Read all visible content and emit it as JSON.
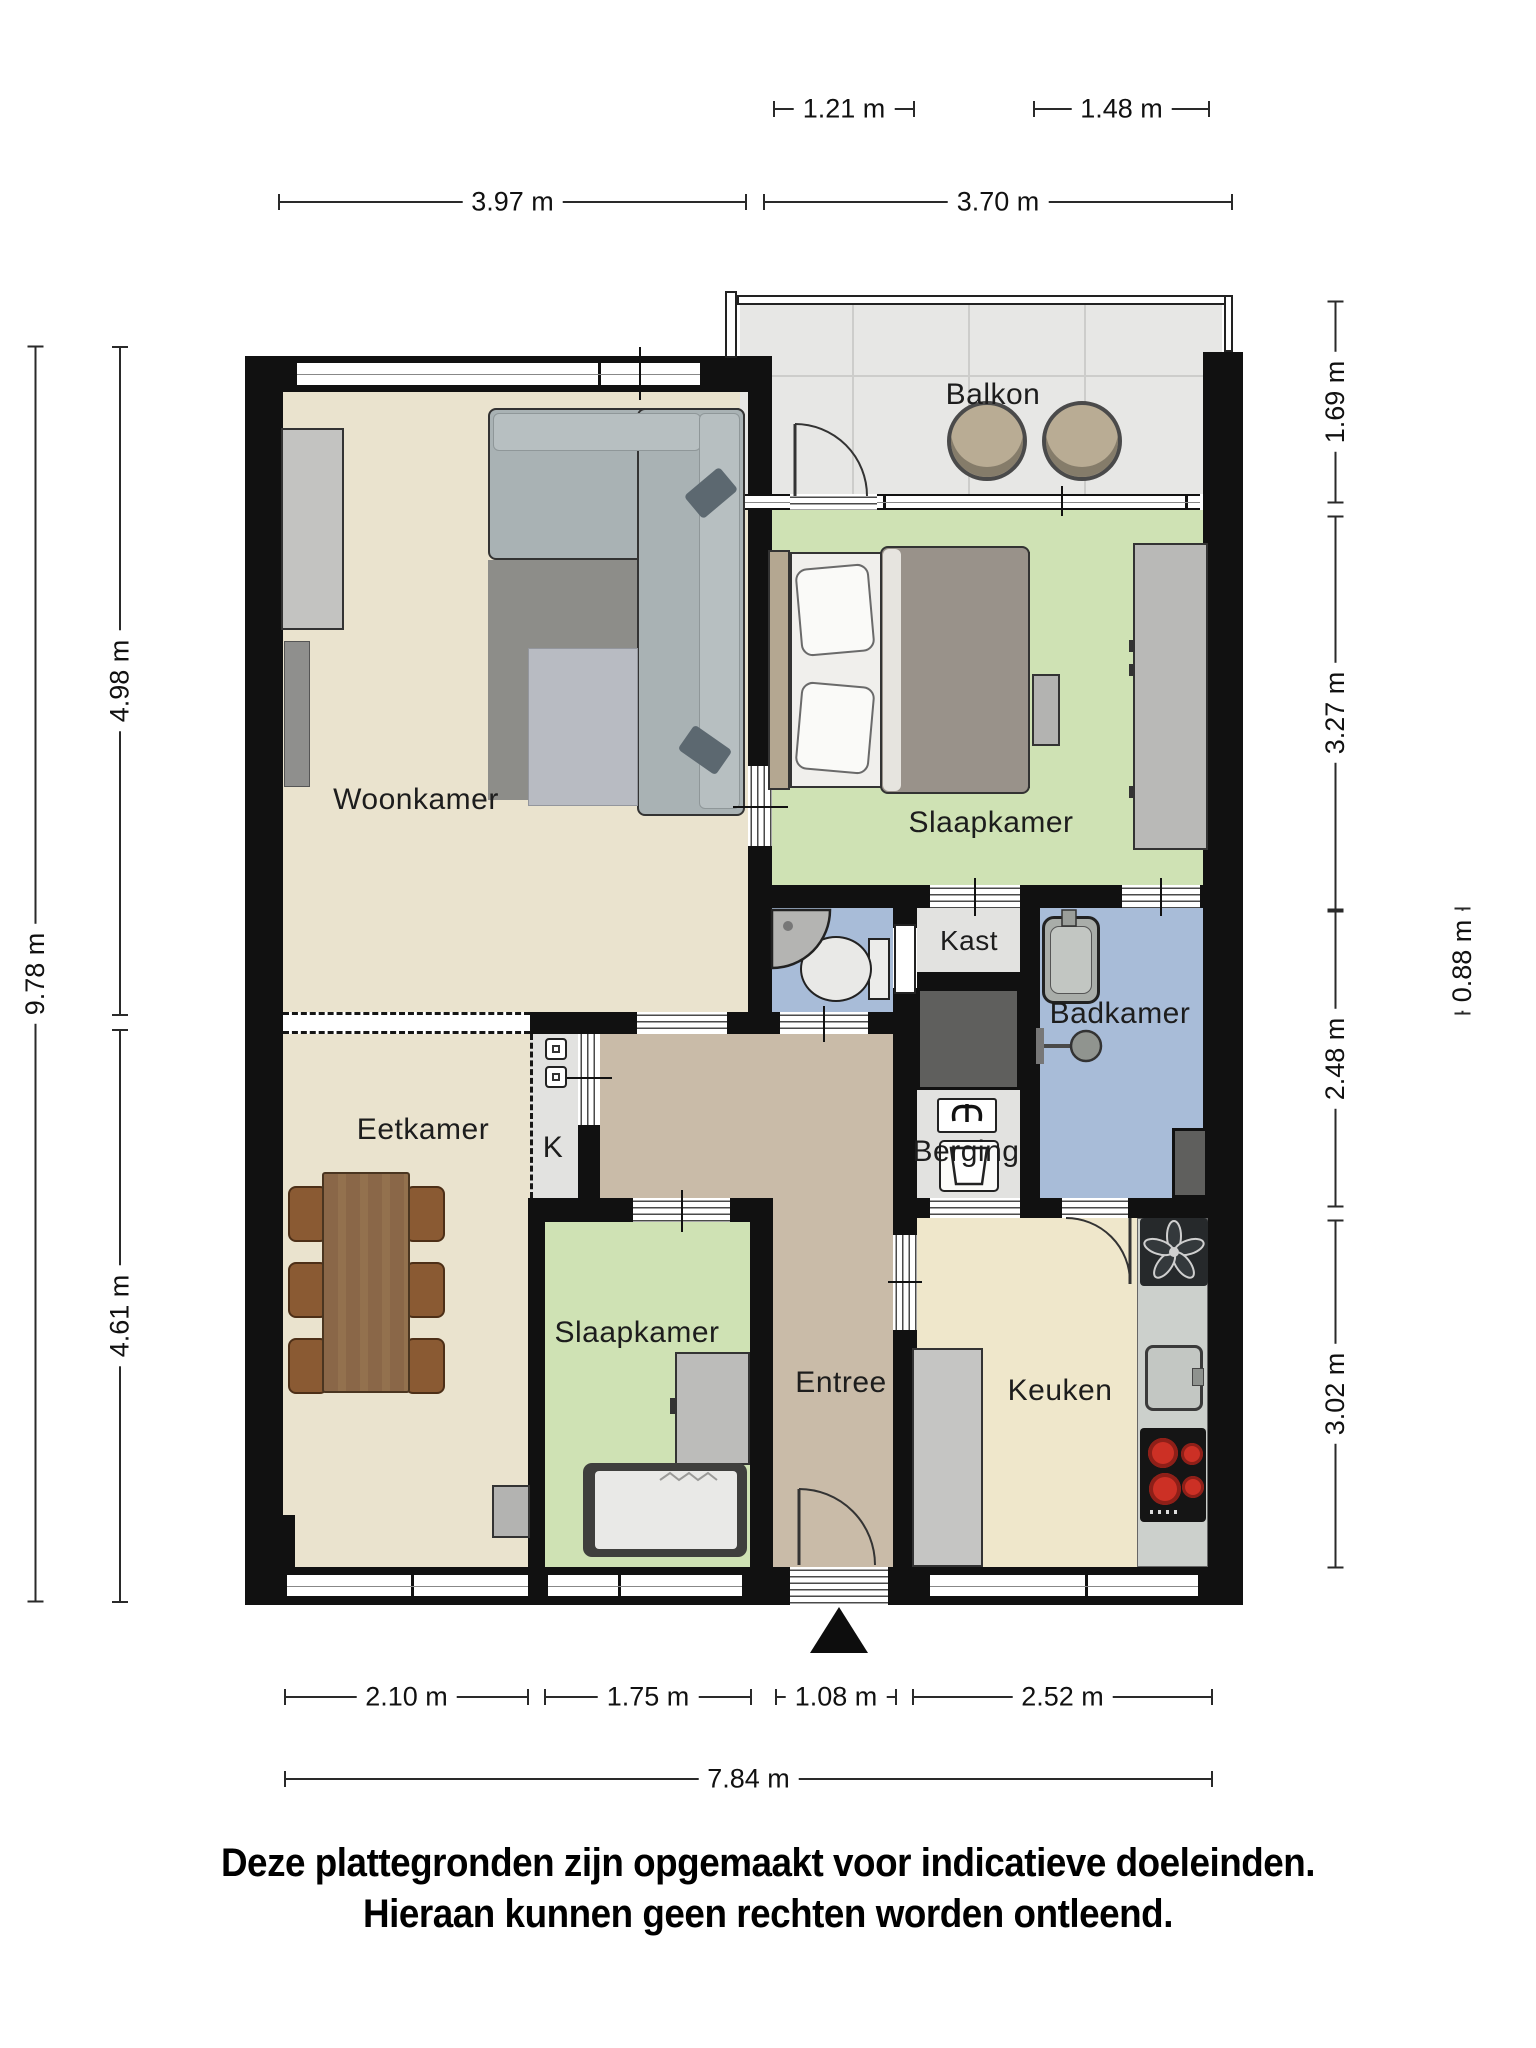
{
  "rooms": {
    "woonkamer": "Woonkamer",
    "slaapkamer_boven": "Slaapkamer",
    "balkon": "Balkon",
    "kast": "Kast",
    "badkamer": "Badkamer",
    "berging": "Berging",
    "eetkamer": "Eetkamer",
    "meterkast": "K",
    "slaapkamer_onder": "Slaapkamer",
    "entree": "Entree",
    "keuken": "Keuken"
  },
  "dimensions": {
    "top_small_left": "1.21 m",
    "top_small_right": "1.48 m",
    "top_left": "3.97 m",
    "top_right": "3.70 m",
    "left_total": "9.78 m",
    "left_upper": "4.98 m",
    "left_lower": "4.61 m",
    "right_balcony": "1.69 m",
    "right_bedroom": "3.27 m",
    "right_inner": "0.88 m",
    "right_bath": "2.48 m",
    "right_kitchen": "3.02 m",
    "bottom_1": "2.10 m",
    "bottom_2": "1.75 m",
    "bottom_3": "1.08 m",
    "bottom_4": "2.52 m",
    "bottom_total": "7.84 m"
  },
  "disclaimer": {
    "line1": "Deze plattegronden zijn opgemaakt voor indicatieve doeleinden.",
    "line2": "Hieraan kunnen geen rechten worden ontleend."
  },
  "colors": {
    "wall": "#111111",
    "floor_living": "#eae3ce",
    "floor_kitchen": "#efe7cb",
    "floor_hall": "#c9bba8",
    "floor_bedroom": "#cfe2b4",
    "floor_bath": "#a8bcd8",
    "floor_balcony": "#e7e7e5",
    "floor_closet": "#e2e2e0",
    "shaft": "#5f5f5d",
    "burner_red": "#cc3025",
    "table_wood": "#8a6748",
    "chair_wood": "#8a5a33",
    "sofa_gray": "#a9b2b4"
  }
}
